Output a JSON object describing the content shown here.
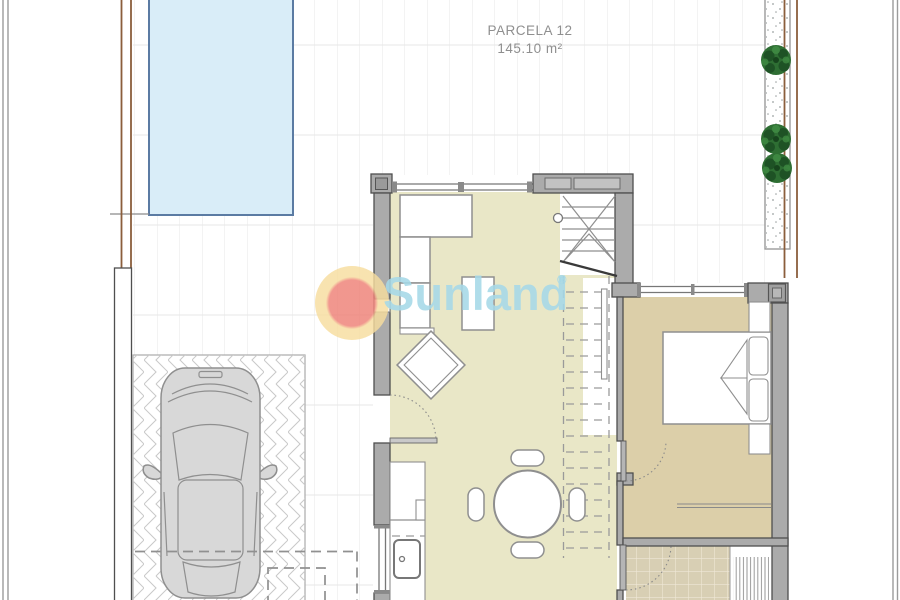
{
  "document": {
    "parcel_label": "PARCELA 12",
    "parcel_area": "145.10 m²"
  },
  "watermark": {
    "brand": "Sunland",
    "registered_mark": "®"
  },
  "plan": {
    "plants_count": 3,
    "dining_chairs_count": 4,
    "rooms_shown": [
      "terrace",
      "pool",
      "garage",
      "living-dining-kitchen",
      "bedroom",
      "bathroom",
      "staircase"
    ]
  },
  "colors": {
    "paper": "#ffffff",
    "pool_fill": "#d9edf8",
    "pool_border": "#5b7ba3",
    "floor_living": "#e9e7c7",
    "floor_bedroom": "#dccfa9",
    "floor_bath_tile": "#d8cfb4",
    "wall_fill": "#ababab",
    "wall_stroke": "#4f4f4f",
    "furniture_stroke": "#8f8f8f",
    "tile_line": "#e7e7e7",
    "herringbone_line": "#c9c9c9",
    "fence_brown": "#8b5e3c",
    "boundary_gray": "#9b9b9b",
    "plant_green": "#2e6e33",
    "plant_green_dark": "#1d4f24",
    "car_fill": "#d8d8d8",
    "car_stroke": "#8f8f8f",
    "label_text": "#8f8f8f",
    "watermark_blue": "#a6d9e8",
    "watermark_red": "#ee8076",
    "watermark_glow": "#f7dd9e"
  }
}
